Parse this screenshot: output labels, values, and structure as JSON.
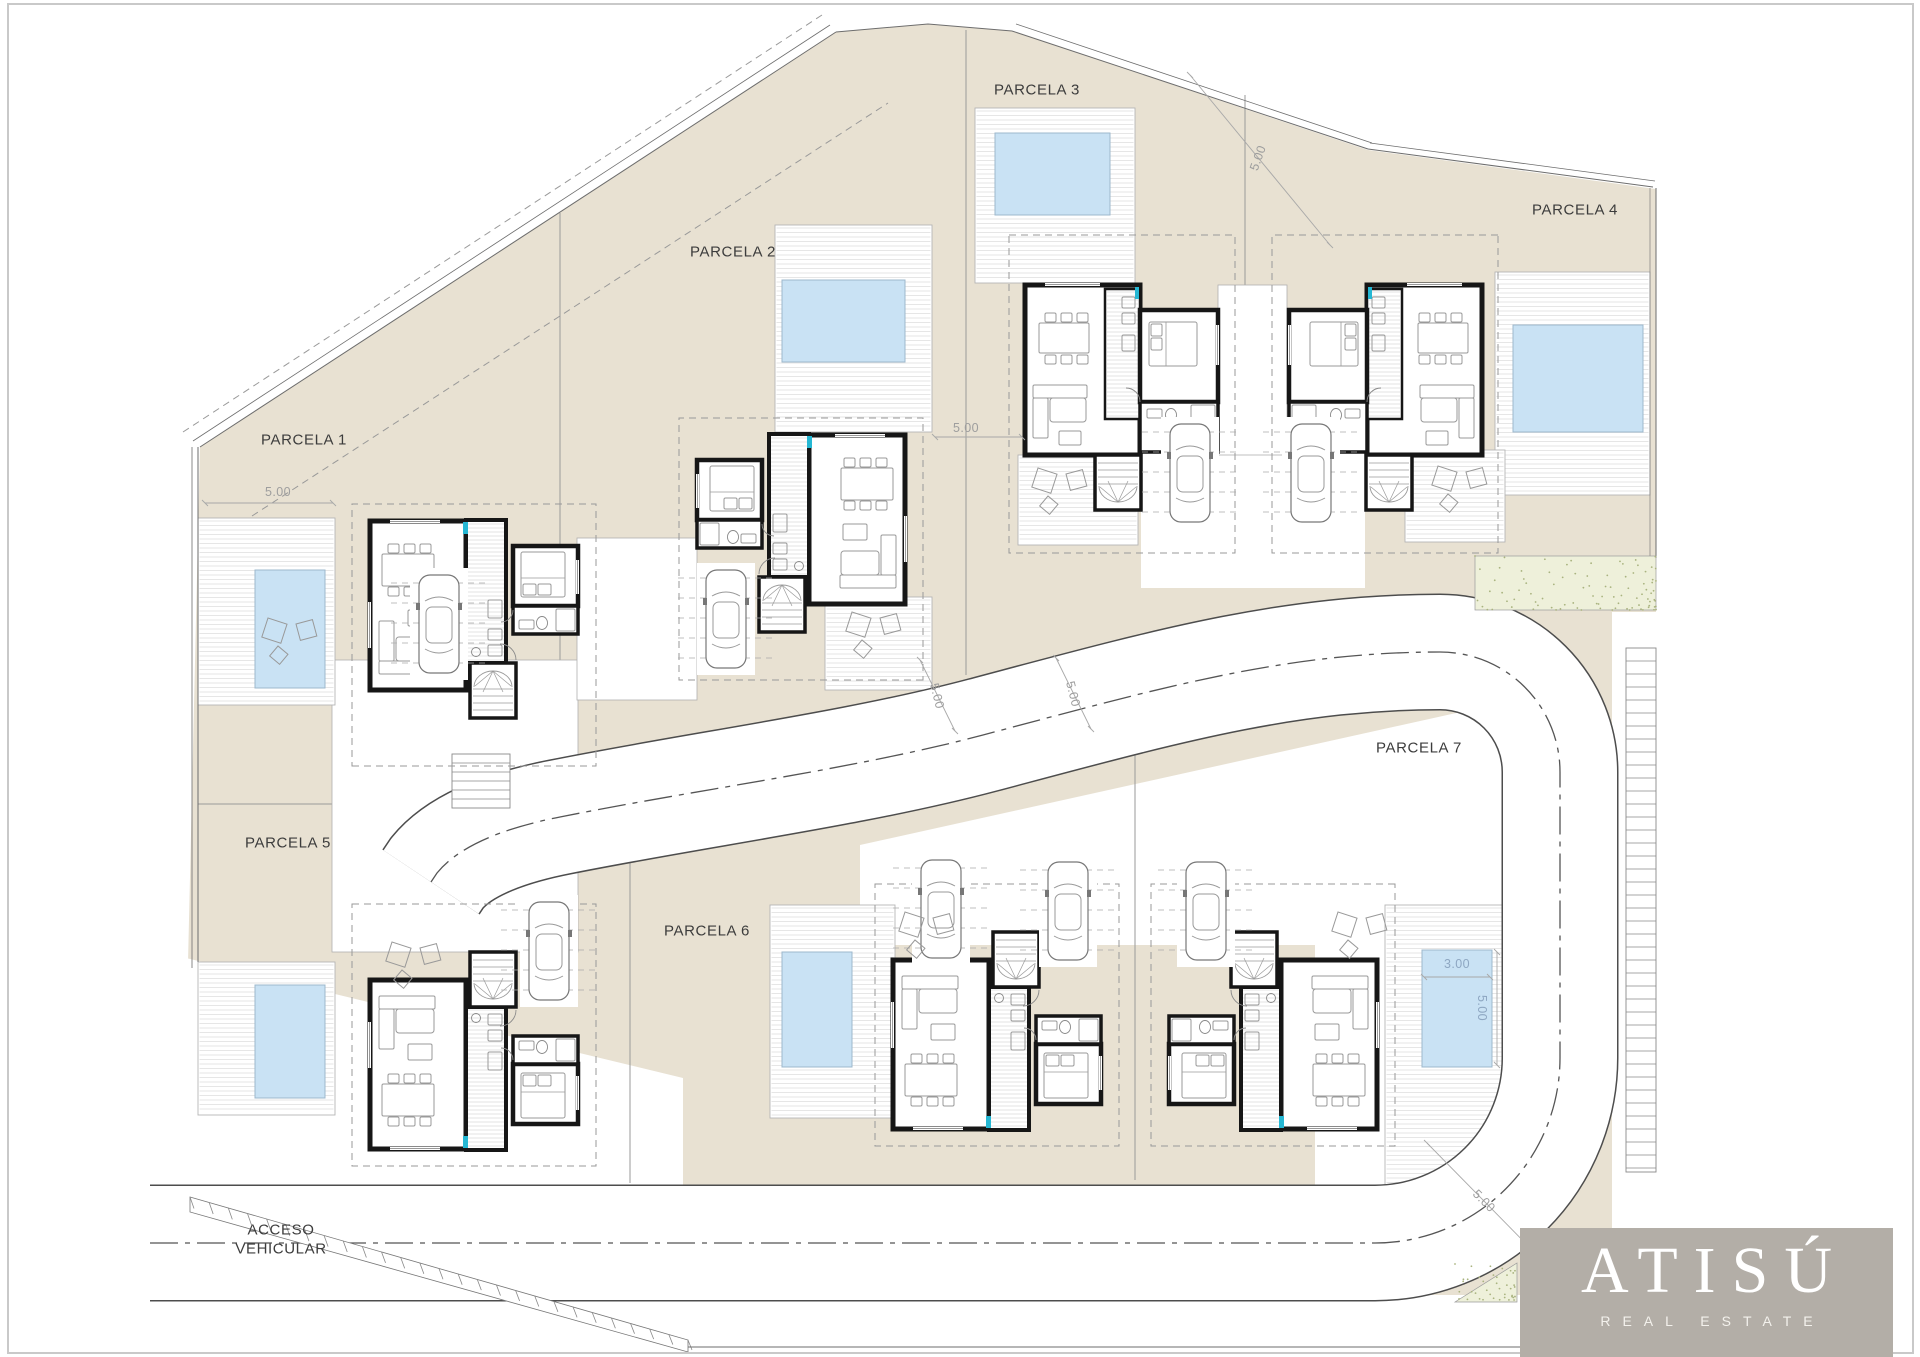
{
  "labels": {
    "parcels": [
      {
        "text": "PARCELA 1",
        "x": 304,
        "y": 440
      },
      {
        "text": "PARCELA 2",
        "x": 733,
        "y": 252
      },
      {
        "text": "PARCELA 3",
        "x": 1037,
        "y": 90
      },
      {
        "text": "PARCELA 4",
        "x": 1575,
        "y": 210
      },
      {
        "text": "PARCELA 5",
        "x": 288,
        "y": 843
      },
      {
        "text": "PARCELA 6",
        "x": 707,
        "y": 931
      },
      {
        "text": "PARCELA 7",
        "x": 1419,
        "y": 748
      }
    ],
    "access": {
      "line1": "ACCESO",
      "line2": "VEHICULAR",
      "x": 281,
      "y": 1240
    }
  },
  "dimensions": [
    {
      "text": "5.00",
      "x": 278,
      "y": 492,
      "rot": 0,
      "color": "gray"
    },
    {
      "text": "5.00",
      "x": 966,
      "y": 428,
      "rot": 0,
      "color": "gray"
    },
    {
      "text": "5.00",
      "x": 1258,
      "y": 158,
      "rot": -70,
      "color": "gray"
    },
    {
      "text": "5.00",
      "x": 937,
      "y": 696,
      "rot": 76,
      "color": "gray"
    },
    {
      "text": "5.00",
      "x": 1073,
      "y": 694,
      "rot": 76,
      "color": "gray"
    },
    {
      "text": "3.00",
      "x": 1457,
      "y": 964,
      "rot": 0,
      "color": "blue"
    },
    {
      "text": "5.00",
      "x": 1482,
      "y": 1008,
      "rot": 90,
      "color": "blue"
    },
    {
      "text": "5.00",
      "x": 1484,
      "y": 1201,
      "rot": 45,
      "color": "gray"
    }
  ],
  "logo": {
    "title": "ATISÚ",
    "subtitle": "REAL ESTATE",
    "x": 1520,
    "y": 1228,
    "w": 373,
    "h": 129,
    "bg": "#b3aea7",
    "fg": "#ffffff"
  },
  "colors": {
    "parcel": "#e8e1d2",
    "parcel_line": "#9a9a9a",
    "pool": "#c9e2f4",
    "pool_line": "#9db8cc",
    "wall": "#161616",
    "furniture": "#9a9a9a",
    "deck_line": "#dedede",
    "deck_border": "#b5b5b5",
    "road_casing": "#4d4d4d",
    "road_fill": "#ffffff",
    "center_line": "#555555",
    "dash": "#999999",
    "teal": "#25b7d3",
    "speckle_bg": "#eef0da",
    "speckle_dot": "#a9b37f",
    "frame": "#c9c9c9",
    "white": "#ffffff",
    "kitchen_hatch": "#c8c8c8",
    "step_line": "#8a8a8a"
  },
  "geometry": {
    "site": {
      "points": "200,447 836,32 928,24 1012,31 1368,150 1656,189 1656,1300 188,1300 188,963"
    },
    "whites": [
      {
        "type": "poly",
        "pts": "186,958 683,1078 683,1357 186,1357"
      },
      {
        "type": "rect",
        "x": 1656,
        "y": 100,
        "w": 260,
        "h": 1250
      },
      {
        "type": "rect",
        "x": 100,
        "y": 1295,
        "w": 1560,
        "h": 62
      },
      {
        "type": "rect",
        "x": 1612,
        "y": 612,
        "w": 46,
        "h": 690
      },
      {
        "type": "poly",
        "pts": "860,845 1515,700 1515,945 860,945"
      },
      {
        "type": "rect",
        "x": 1315,
        "y": 932,
        "w": 75,
        "h": 268
      },
      {
        "type": "rect",
        "x": 1141,
        "y": 452,
        "w": 224,
        "h": 136
      }
    ],
    "road": {
      "path": "M 150 1243 L 1375 1243 A 185 185 0 0 0 1560 1058 L 1560 772 A 120 120 0 0 0 1440 652 C 1285 652 1160 688 983 735 C 855 769 700 789 560 817 Q 468 835 437 873 L 431 882",
      "width": 114,
      "center_dash": "28 7 5 7"
    },
    "drives": [
      {
        "x": 332,
        "y": 660,
        "w": 246,
        "h": 292
      },
      {
        "x": 577,
        "y": 538,
        "w": 120,
        "h": 162
      },
      {
        "x": 1218,
        "y": 285,
        "w": 69,
        "h": 170
      }
    ],
    "decks": [
      {
        "x": 198,
        "y": 518,
        "w": 137,
        "h": 187
      },
      {
        "x": 775,
        "y": 225,
        "w": 157,
        "h": 207
      },
      {
        "x": 975,
        "y": 108,
        "w": 160,
        "h": 175
      },
      {
        "x": 1495,
        "y": 272,
        "w": 155,
        "h": 223
      },
      {
        "x": 198,
        "y": 962,
        "w": 137,
        "h": 153
      },
      {
        "x": 770,
        "y": 905,
        "w": 125,
        "h": 213
      },
      {
        "x": 1385,
        "y": 905,
        "w": 118,
        "h": 295
      },
      {
        "x": 825,
        "y": 597,
        "w": 107,
        "h": 93
      },
      {
        "x": 1018,
        "y": 455,
        "w": 120,
        "h": 90
      },
      {
        "x": 1405,
        "y": 450,
        "w": 100,
        "h": 92
      }
    ],
    "pools": [
      {
        "x": 255,
        "y": 570,
        "w": 70,
        "h": 118
      },
      {
        "x": 782,
        "y": 280,
        "w": 123,
        "h": 82
      },
      {
        "x": 995,
        "y": 133,
        "w": 115,
        "h": 82
      },
      {
        "x": 1513,
        "y": 325,
        "w": 130,
        "h": 107
      },
      {
        "x": 255,
        "y": 985,
        "w": 70,
        "h": 113
      },
      {
        "x": 782,
        "y": 952,
        "w": 70,
        "h": 115
      },
      {
        "x": 1422,
        "y": 950,
        "w": 70,
        "h": 117
      }
    ],
    "houses": [
      {
        "type": "V",
        "tx": 370,
        "ty": 718,
        "sx": 1,
        "sy": -1,
        "name": "house-parcela-1"
      },
      {
        "type": "V",
        "tx": 905,
        "ty": 632,
        "sx": -1,
        "sy": -1,
        "name": "house-parcela-2"
      },
      {
        "type": "B",
        "tx": 1025,
        "ty": 285,
        "sx": 1,
        "sy": 1,
        "name": "house-parcela-3"
      },
      {
        "type": "B",
        "tx": 1482,
        "ty": 285,
        "sx": -1,
        "sy": 1,
        "name": "house-parcela-4"
      },
      {
        "type": "V",
        "tx": 370,
        "ty": 952,
        "sx": 1,
        "sy": 1,
        "name": "house-parcela-5"
      },
      {
        "type": "V",
        "tx": 893,
        "ty": 932,
        "sx": 1,
        "sy": 1,
        "name": "house-parcela-6"
      },
      {
        "type": "V",
        "tx": 1377,
        "ty": 932,
        "sx": -1,
        "sy": 1,
        "name": "house-parcela-7"
      }
    ],
    "cars": [
      {
        "x": 419,
        "y": 575
      },
      {
        "x": 706,
        "y": 570
      },
      {
        "x": 1170,
        "y": 424
      },
      {
        "x": 1291,
        "y": 424
      },
      {
        "x": 529,
        "y": 902
      },
      {
        "x": 921,
        "y": 860
      },
      {
        "x": 1048,
        "y": 862
      },
      {
        "x": 1186,
        "y": 862
      }
    ],
    "furniture": [
      {
        "x": 268,
        "y": 618
      },
      {
        "x": 852,
        "y": 612
      },
      {
        "x": 1038,
        "y": 468
      },
      {
        "x": 1438,
        "y": 466
      },
      {
        "x": 905,
        "y": 912
      },
      {
        "x": 1338,
        "y": 912
      },
      {
        "x": 392,
        "y": 942
      }
    ],
    "steps": [
      {
        "x": 1626,
        "y": 648,
        "w": 30,
        "h": 524,
        "gap": 13
      },
      {
        "x": 452,
        "y": 754,
        "w": 58,
        "h": 54,
        "gap": 9
      }
    ],
    "speckles": [
      {
        "type": "rect",
        "x": 1475,
        "y": 556,
        "w": 181,
        "h": 54
      },
      {
        "type": "poly",
        "pts": "1517,1263 1517,1302 1455,1302"
      }
    ],
    "boundaries": [
      {
        "pts": "200,447 836,32",
        "w": 1
      },
      {
        "pts": "193,441 830,25",
        "w": 0.8
      },
      {
        "pts": "836,32 928,24 1012,31",
        "w": 1
      },
      {
        "pts": "1012,31 1368,149",
        "w": 1
      },
      {
        "pts": "1016,24 1372,143",
        "w": 0.8
      },
      {
        "pts": "1368,149 1653,187",
        "w": 1
      },
      {
        "pts": "1370,143 1655,181",
        "w": 0.8
      },
      {
        "pts": "1656,188 1656,558",
        "w": 1
      },
      {
        "pts": "1650,188 1650,560",
        "w": 0.6
      },
      {
        "pts": "198,447 198,962",
        "w": 1
      },
      {
        "pts": "192,447 192,968",
        "w": 0.8
      },
      {
        "pts": "688,1347 1893,1347",
        "w": 0.9
      }
    ],
    "dashed_lines": [
      {
        "pts": "183,432 822,15"
      },
      {
        "pts": "252,516 888,103"
      }
    ],
    "dividers": [
      {
        "x1": 560,
        "y1": 213,
        "x2": 560,
        "y2": 660
      },
      {
        "x1": 966,
        "y1": 30,
        "x2": 966,
        "y2": 675
      },
      {
        "x1": 1245,
        "y1": 95,
        "x2": 1245,
        "y2": 285
      },
      {
        "x1": 198,
        "y1": 804,
        "x2": 578,
        "y2": 804
      },
      {
        "x1": 630,
        "y1": 850,
        "x2": 630,
        "y2": 1183
      },
      {
        "x1": 1135,
        "y1": 715,
        "x2": 1135,
        "y2": 1180
      }
    ],
    "dim_lines": [
      {
        "x1": 205,
        "y1": 503,
        "x2": 333,
        "y2": 503
      },
      {
        "x1": 935,
        "y1": 437,
        "x2": 1022,
        "y2": 437
      },
      {
        "x1": 1190,
        "y1": 75,
        "x2": 1330,
        "y2": 245
      },
      {
        "x1": 920,
        "y1": 660,
        "x2": 955,
        "y2": 731
      },
      {
        "x1": 1056,
        "y1": 658,
        "x2": 1091,
        "y2": 729
      },
      {
        "x1": 1424,
        "y1": 977,
        "x2": 1490,
        "y2": 977
      },
      {
        "x1": 1497,
        "y1": 952,
        "x2": 1497,
        "y2": 1065
      },
      {
        "x1": 1427,
        "y1": 1143,
        "x2": 1537,
        "y2": 1255
      }
    ],
    "gate_hatch": {
      "pts": "190,1197 688,1340 688,1352 190,1212",
      "ticks": 26
    }
  }
}
